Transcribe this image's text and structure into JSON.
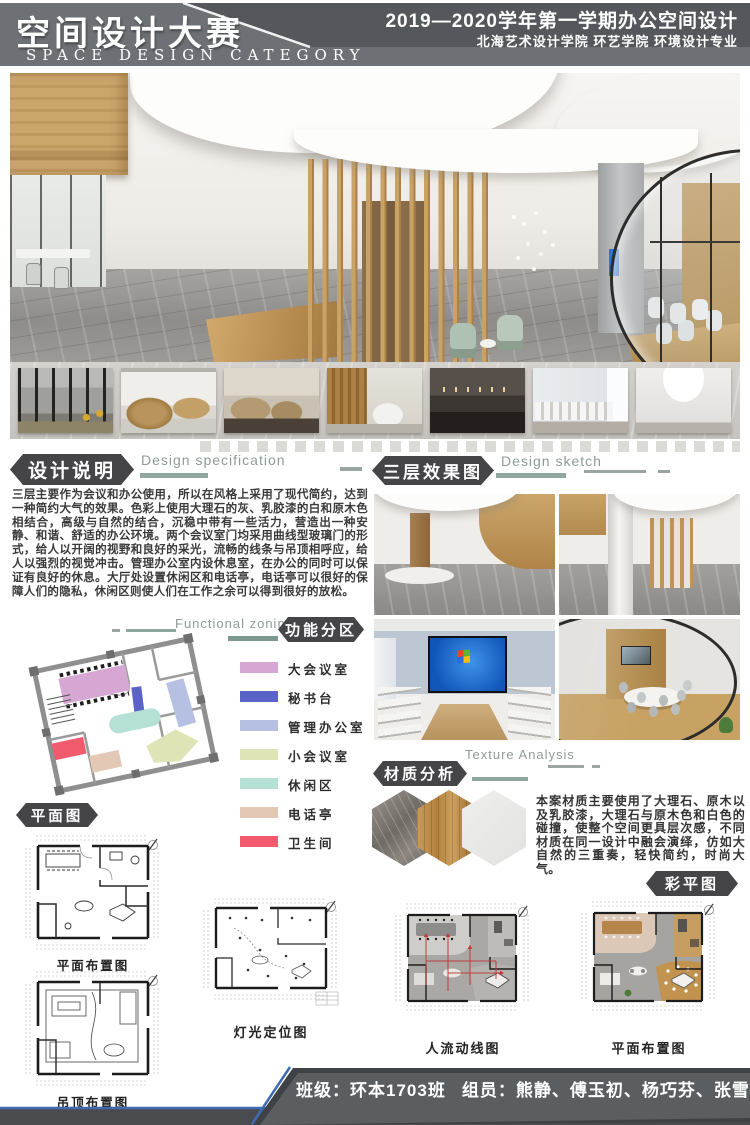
{
  "header": {
    "title_cn": "空间设计大赛",
    "title_en": "SPACE DESIGN CATEGORY",
    "term_line": "2019—2020学年第一学期办公空间设计",
    "school_line": "北海艺术设计学院 环艺学院 环境设计专业"
  },
  "design_spec": {
    "label_cn": "设计说明",
    "label_en": "Design specification",
    "body": "三层主要作为会议和办公使用，所以在风格上采用了现代简约，达到一种简约大气的效果。色彩上使用大理石的灰、乳胶漆的白和原木色相结合，高级与自然的结合，沉稳中带有一些活力，营造出一种安静、和谐、舒适的办公环境。两个会议室门均采用曲线型玻璃门的形式，给人以开阔的视野和良好的采光，流畅的线条与吊顶相呼应，给人以强烈的视觉冲击。管理办公室内设休息室，在办公的同时可以保证有良好的休息。大厅处设置休闲区和电话亭，电话亭可以很好的保障人们的隐私，休闲区则使人们在工作之余可以得到很好的放松。"
  },
  "sketch": {
    "label_cn": "三层效果图",
    "label_en": "Design sketch"
  },
  "zoning": {
    "label_cn": "功能分区",
    "label_en": "Functional zoning",
    "legend": [
      {
        "label": "大会议室",
        "color": "#d6a7d3"
      },
      {
        "label": "秘书台",
        "color": "#5a64c6"
      },
      {
        "label": "管理办公室",
        "color": "#b6c0e3"
      },
      {
        "label": "小会议室",
        "color": "#dfe4b6"
      },
      {
        "label": "休闲区",
        "color": "#b4e0d6"
      },
      {
        "label": "电话亭",
        "color": "#e3c8b5"
      },
      {
        "label": "卫生间",
        "color": "#f25a6e"
      }
    ]
  },
  "plans": {
    "label_cn": "平面图",
    "caption_layout": "平面布置图",
    "caption_ceiling": "吊顶布置图",
    "caption_lighting": "灯光定位图"
  },
  "texture": {
    "label_cn": "材质分析",
    "label_en": "Texture Analysis",
    "body": "本案材质主要使用了大理石、原木以及乳胶漆，大理石与原木色和白色的碰撞，使整个空间更具层次感，不同材质在同一设计中融会演绎，仿如大自然的三重奏，轻快简约，时尚大气。",
    "materials": [
      "marble",
      "wood",
      "white-paint"
    ]
  },
  "color_plan": {
    "label_cn": "彩平图",
    "caption_flow": "人流动线图",
    "caption_layout": "平面布置图"
  },
  "footer": {
    "class_text": "班级：环本1703班",
    "members_text": "组员：熊静、傅玉初、杨巧芬、张雪琪、马星星",
    "accent_blue": "#3d6cb3"
  }
}
